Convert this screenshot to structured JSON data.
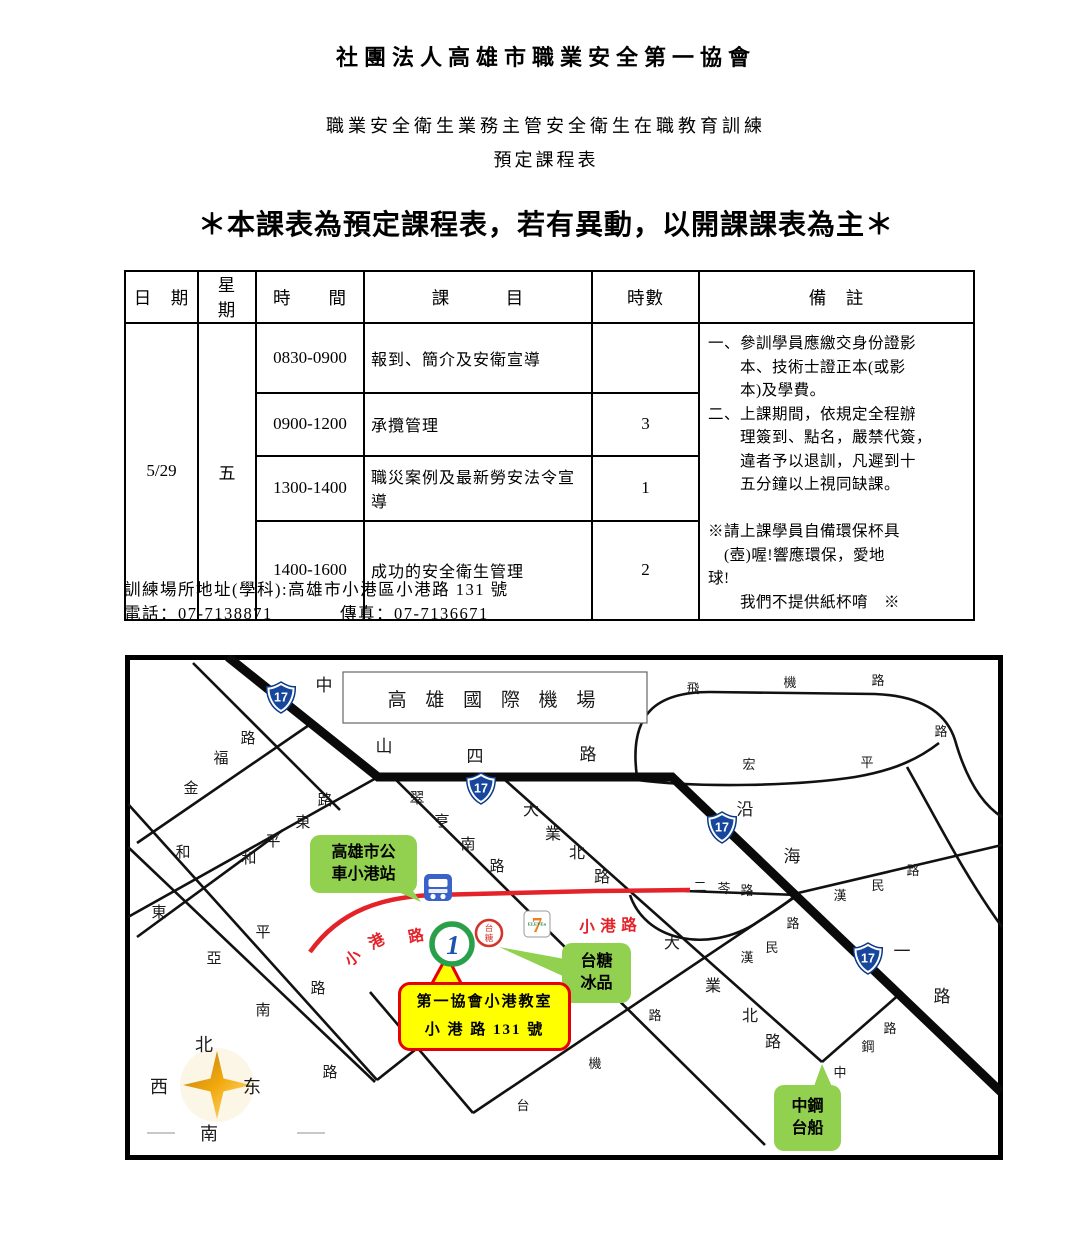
{
  "header": {
    "org_title": "社團法人高雄市職業安全第一協會",
    "training_line": "職業安全衛生業務主管安全衛生在職教育訓練",
    "schedule_line": "預定課程表",
    "notice": "＊本課表為預定課程表，若有異動，以開課課表為主＊"
  },
  "schedule": {
    "headers": {
      "date": "日　期",
      "weekday": "星　期",
      "time": "時　　間",
      "subject": "課　　　目",
      "hours": "時數",
      "remarks": "備　註"
    },
    "date": "5/29",
    "weekday": "五",
    "rows": [
      {
        "time": "0830-0900",
        "subject": "報到、簡介及安衛宣導",
        "hours": ""
      },
      {
        "time": "0900-1200",
        "subject": "承攬管理",
        "hours": "3"
      },
      {
        "time": "1300-1400",
        "subject": "職災案例及最新勞安法令宣導",
        "hours": "1"
      },
      {
        "time": "1400-1600",
        "subject": "成功的安全衛生管理",
        "hours": "2"
      }
    ],
    "remarks_lines": [
      "一、參訓學員應繳交身份證影",
      "　　本、技術士證正本(或影",
      "　　本)及學費。",
      "二、上課期間，依規定全程辦",
      "　　理簽到、點名，嚴禁代簽，",
      "　　違者予以退訓，凡遲到十",
      "　　五分鐘以上視同缺課。",
      "",
      "※請上課學員自備環保杯具",
      "　(壺)喔!響應環保，愛地",
      "球!",
      "　　我們不提供紙杯唷　※"
    ]
  },
  "contact": {
    "address": "訓練場所地址(學科):高雄市小港區小港路 131 號",
    "phone": "電話：07-7138871",
    "fax": "傳真：07-7136671"
  },
  "map": {
    "airport_label": "高 雄 國 際 機 場",
    "shield_label": "17",
    "shields": [
      {
        "x": 156,
        "y": 42
      },
      {
        "x": 356,
        "y": 133
      },
      {
        "x": 597,
        "y": 172
      },
      {
        "x": 743,
        "y": 303
      }
    ],
    "road_labels": [
      {
        "t": "金",
        "x": 66,
        "y": 138
      },
      {
        "t": "福",
        "x": 96,
        "y": 108
      },
      {
        "t": "路",
        "x": 123,
        "y": 88
      },
      {
        "t": "路",
        "x": 200,
        "y": 150
      },
      {
        "t": "東",
        "x": 178,
        "y": 172
      },
      {
        "t": "平",
        "x": 148,
        "y": 191
      },
      {
        "t": "和",
        "x": 58,
        "y": 202
      },
      {
        "t": "和",
        "x": 124,
        "y": 208
      },
      {
        "t": "東",
        "x": 34,
        "y": 262
      },
      {
        "t": "平",
        "x": 138,
        "y": 282
      },
      {
        "t": "亞",
        "x": 89,
        "y": 308
      },
      {
        "t": "路",
        "x": 193,
        "y": 338
      },
      {
        "t": "南",
        "x": 138,
        "y": 360
      },
      {
        "t": "路",
        "x": 205,
        "y": 422
      },
      {
        "t": "中",
        "x": 199,
        "y": 36,
        "s": 17
      },
      {
        "t": "山",
        "x": 259,
        "y": 97,
        "s": 17
      },
      {
        "t": "四",
        "x": 350,
        "y": 107,
        "s": 17
      },
      {
        "t": "路",
        "x": 463,
        "y": 105,
        "s": 17
      },
      {
        "t": "翠",
        "x": 292,
        "y": 148
      },
      {
        "t": "亨",
        "x": 317,
        "y": 171
      },
      {
        "t": "南",
        "x": 343,
        "y": 194
      },
      {
        "t": "路",
        "x": 372,
        "y": 216
      },
      {
        "t": "大",
        "x": 406,
        "y": 160,
        "s": 16
      },
      {
        "t": "業",
        "x": 428,
        "y": 184,
        "s": 16
      },
      {
        "t": "北",
        "x": 452,
        "y": 203,
        "s": 16
      },
      {
        "t": "路",
        "x": 477,
        "y": 227,
        "s": 16
      },
      {
        "t": "二",
        "x": 575,
        "y": 236,
        "s": 13
      },
      {
        "t": "苓",
        "x": 599,
        "y": 238,
        "s": 13
      },
      {
        "t": "路",
        "x": 622,
        "y": 240,
        "s": 13
      },
      {
        "t": "沿",
        "x": 620,
        "y": 160,
        "s": 17
      },
      {
        "t": "海",
        "x": 667,
        "y": 207,
        "s": 17
      },
      {
        "t": "一",
        "x": 777,
        "y": 302,
        "s": 17
      },
      {
        "t": "路",
        "x": 817,
        "y": 347,
        "s": 17
      },
      {
        "t": "飛",
        "x": 568,
        "y": 38,
        "s": 13
      },
      {
        "t": "機",
        "x": 665,
        "y": 32,
        "s": 13
      },
      {
        "t": "路",
        "x": 753,
        "y": 30,
        "s": 13
      },
      {
        "t": "宏",
        "x": 624,
        "y": 114,
        "s": 13
      },
      {
        "t": "平",
        "x": 742,
        "y": 112,
        "s": 13
      },
      {
        "t": "路",
        "x": 816,
        "y": 81,
        "s": 13
      },
      {
        "t": "漢",
        "x": 715,
        "y": 245,
        "s": 13
      },
      {
        "t": "民",
        "x": 753,
        "y": 235,
        "s": 13
      },
      {
        "t": "路",
        "x": 788,
        "y": 220,
        "s": 13
      },
      {
        "t": "漢",
        "x": 622,
        "y": 307,
        "s": 13
      },
      {
        "t": "民",
        "x": 647,
        "y": 297,
        "s": 13
      },
      {
        "t": "路",
        "x": 668,
        "y": 273,
        "s": 13
      },
      {
        "t": "大",
        "x": 547,
        "y": 293,
        "s": 16
      },
      {
        "t": "業",
        "x": 588,
        "y": 336,
        "s": 16
      },
      {
        "t": "北",
        "x": 625,
        "y": 366,
        "s": 16
      },
      {
        "t": "路",
        "x": 648,
        "y": 392,
        "s": 16
      },
      {
        "t": "台",
        "x": 398,
        "y": 455,
        "s": 13
      },
      {
        "t": "機",
        "x": 470,
        "y": 413,
        "s": 13
      },
      {
        "t": "路",
        "x": 530,
        "y": 365,
        "s": 13
      },
      {
        "t": "中",
        "x": 715,
        "y": 422,
        "s": 13
      },
      {
        "t": "鋼",
        "x": 743,
        "y": 396,
        "s": 13
      },
      {
        "t": "路",
        "x": 765,
        "y": 378,
        "s": 13
      }
    ],
    "red_road_labels": [
      {
        "t": "小",
        "x": 231,
        "y": 307,
        "r": -38
      },
      {
        "t": "港",
        "x": 254,
        "y": 291,
        "r": -28
      },
      {
        "t": "路",
        "x": 292,
        "y": 286,
        "r": -12
      },
      {
        "t": "小",
        "x": 462,
        "y": 277
      },
      {
        "t": "港",
        "x": 483,
        "y": 276
      },
      {
        "t": "路",
        "x": 504,
        "y": 275
      }
    ],
    "callouts": {
      "bus_station": {
        "lines": [
          "高雄市公",
          "車小港站"
        ]
      },
      "taitang": {
        "lines": [
          "台糖",
          "冰品"
        ]
      },
      "assoc": {
        "lines": [
          "第一協會小港教室",
          "小 港 路 131 號"
        ]
      },
      "steel": {
        "lines": [
          "中鋼",
          "台船"
        ]
      }
    },
    "icons": {
      "assoc_logo_text": "1",
      "taitang_text": "台糖",
      "seven_eleven_text": "7",
      "seven_eleven_sub": "ELEVEn"
    },
    "compass": {
      "north": "北",
      "south": "南",
      "west": "西",
      "east": "东"
    }
  },
  "colors": {
    "callout_green": "#92d050",
    "callout_yellow": "#ffff00",
    "callout_red_border": "#e60000",
    "road_red": "#e4222a",
    "shield_blue": "#17479d",
    "bus_blue": "#3a62c8",
    "taitang_red": "#d4342a",
    "seven_orange": "#f07d1f",
    "seven_green": "#0c7a3d"
  }
}
